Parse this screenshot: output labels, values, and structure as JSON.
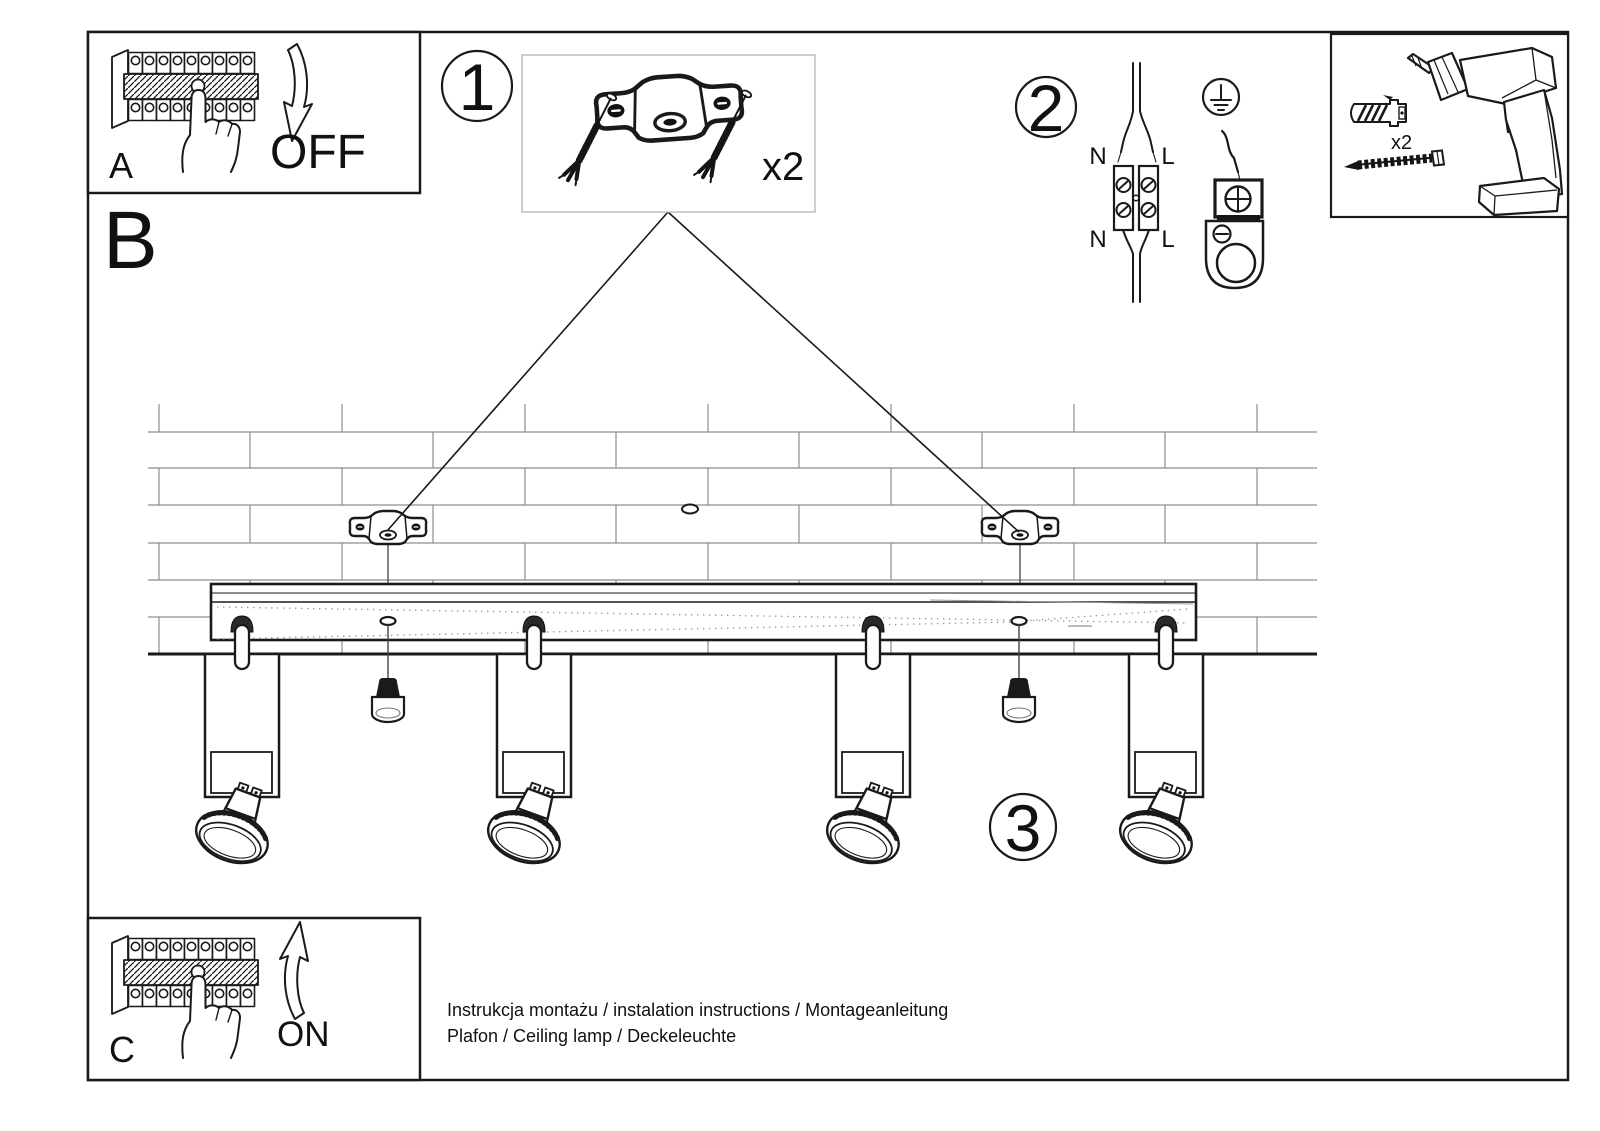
{
  "section_label": "B",
  "panels": {
    "a": {
      "label": "A",
      "state": "OFF"
    },
    "c": {
      "label": "C",
      "state": "ON"
    }
  },
  "steps": {
    "one": "1",
    "two": "2",
    "three": "3"
  },
  "parts_box": {
    "quantity": "x2"
  },
  "tools_box": {
    "anchor_quantity": "x2"
  },
  "wiring": {
    "top_left": "N",
    "top_right": "L",
    "bottom_left": "N",
    "bottom_right": "L"
  },
  "footer": {
    "line1": "Instrukcja montażu / instalation instructions / Montageanleitung",
    "line2": "Plafon / Ceiling lamp / Deckeleuchte"
  },
  "colors": {
    "ink": "#1a1a1a",
    "brick_line": "#8d8d8d",
    "parts_border": "#b8b8b8"
  }
}
